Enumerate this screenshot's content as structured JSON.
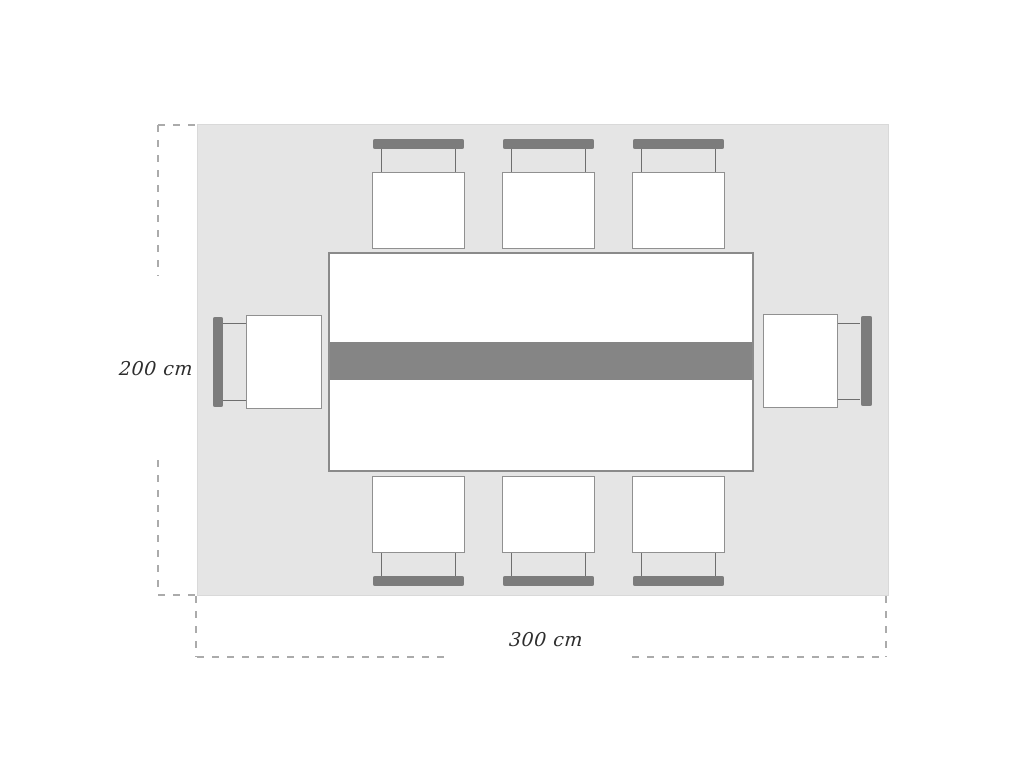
{
  "diagram": {
    "dimension_labels": {
      "height": "200 cm",
      "width": "300 cm"
    },
    "chairs": {
      "top": 3,
      "bottom": 3,
      "left": 1,
      "right": 1,
      "total": 8
    },
    "colors": {
      "rug": "#e5e5e5",
      "rug-border": "#d9d9d9",
      "table-fill": "#ffffff",
      "table-border": "#8a8a8a",
      "runner": "#858585",
      "chair-back": "#7c7c7c",
      "chair-post": "#6e6e6e",
      "seat-border": "#909090",
      "dash": "#ababab",
      "label-ink": "#2d2d2d",
      "page-bg": "#ffffff"
    }
  }
}
